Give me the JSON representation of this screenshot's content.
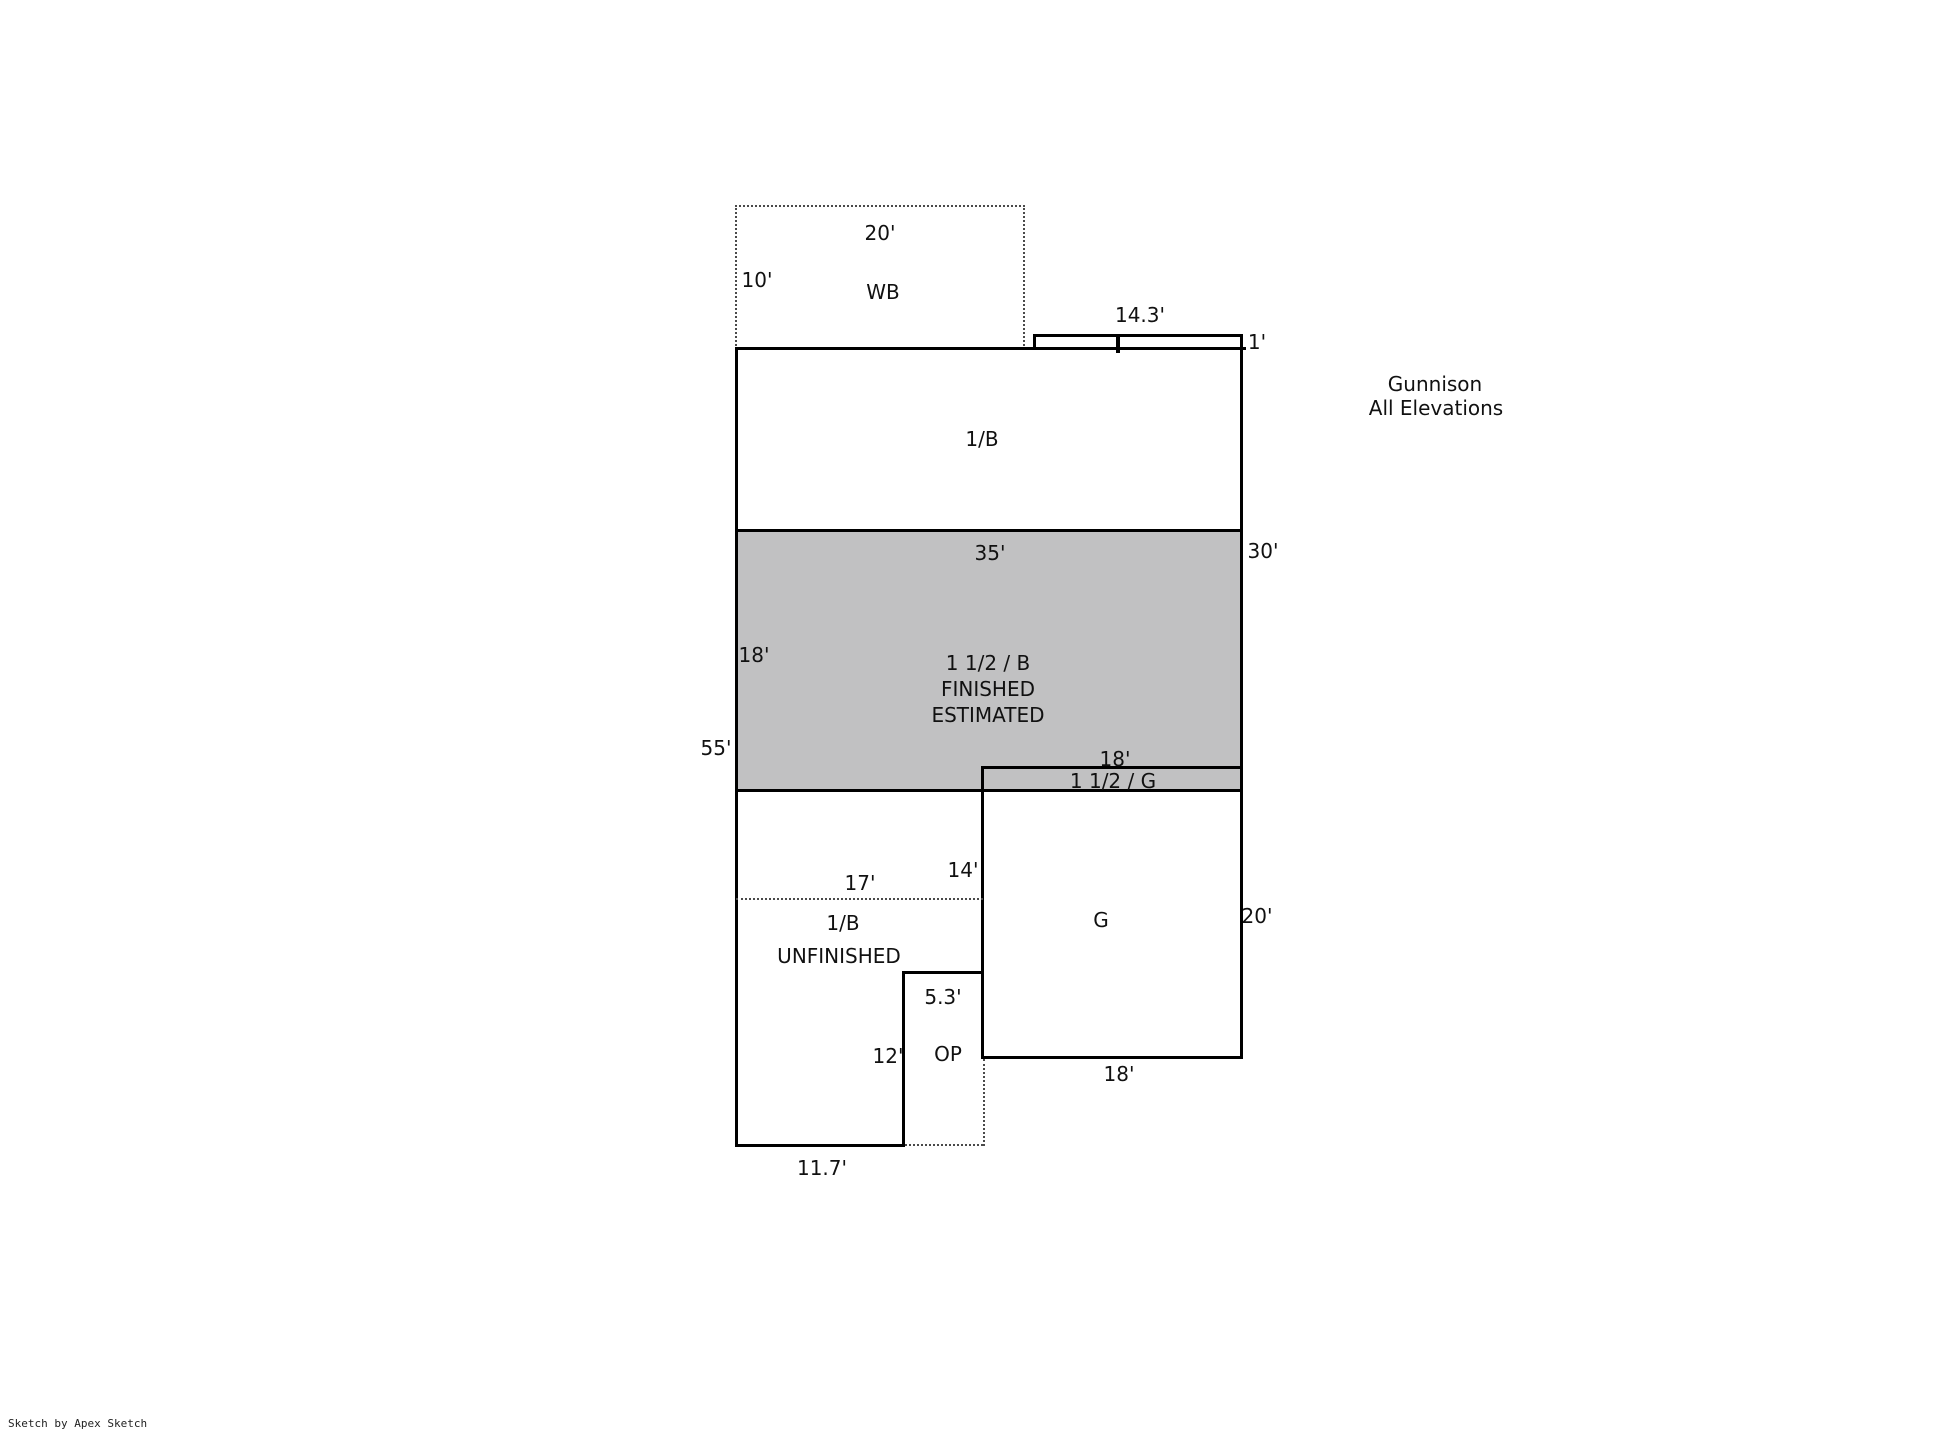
{
  "title": {
    "project": "Gunnison",
    "subtitle": "All Elevations"
  },
  "credit": "Sketch by Apex Sketch",
  "colors": {
    "line": "#000000",
    "shade": "#c1c1c2",
    "background": "#ffffff"
  },
  "labels": {
    "wb": {
      "area": "WB",
      "top_dim": "20'",
      "left_dim": "10'"
    },
    "porch_bump": {
      "top_dim": "14.3'",
      "right_dim": "1'"
    },
    "upper_basement": {
      "area": "1/B",
      "bottom_dim": "35'",
      "right_dim": "30'"
    },
    "finished_area": {
      "name": "1 1/2 / B",
      "status": "FINISHED",
      "note": "ESTIMATED",
      "left_dim": "18'",
      "outer_left_dim": "55'"
    },
    "garage_strip": {
      "area": "1 1/2 / G",
      "top_dim": "18'"
    },
    "garage": {
      "area": "G",
      "right_dim": "20'",
      "bottom_dim": "18'"
    },
    "unfinished_basement": {
      "area": "1/B",
      "status": "UNFINISHED",
      "interior_dim": "17'",
      "right_dim": "14'",
      "notch_top_dim": "5.3'",
      "notch_left_dim": "12'",
      "porch": "OP",
      "bottom_dim": "11.7'"
    }
  }
}
